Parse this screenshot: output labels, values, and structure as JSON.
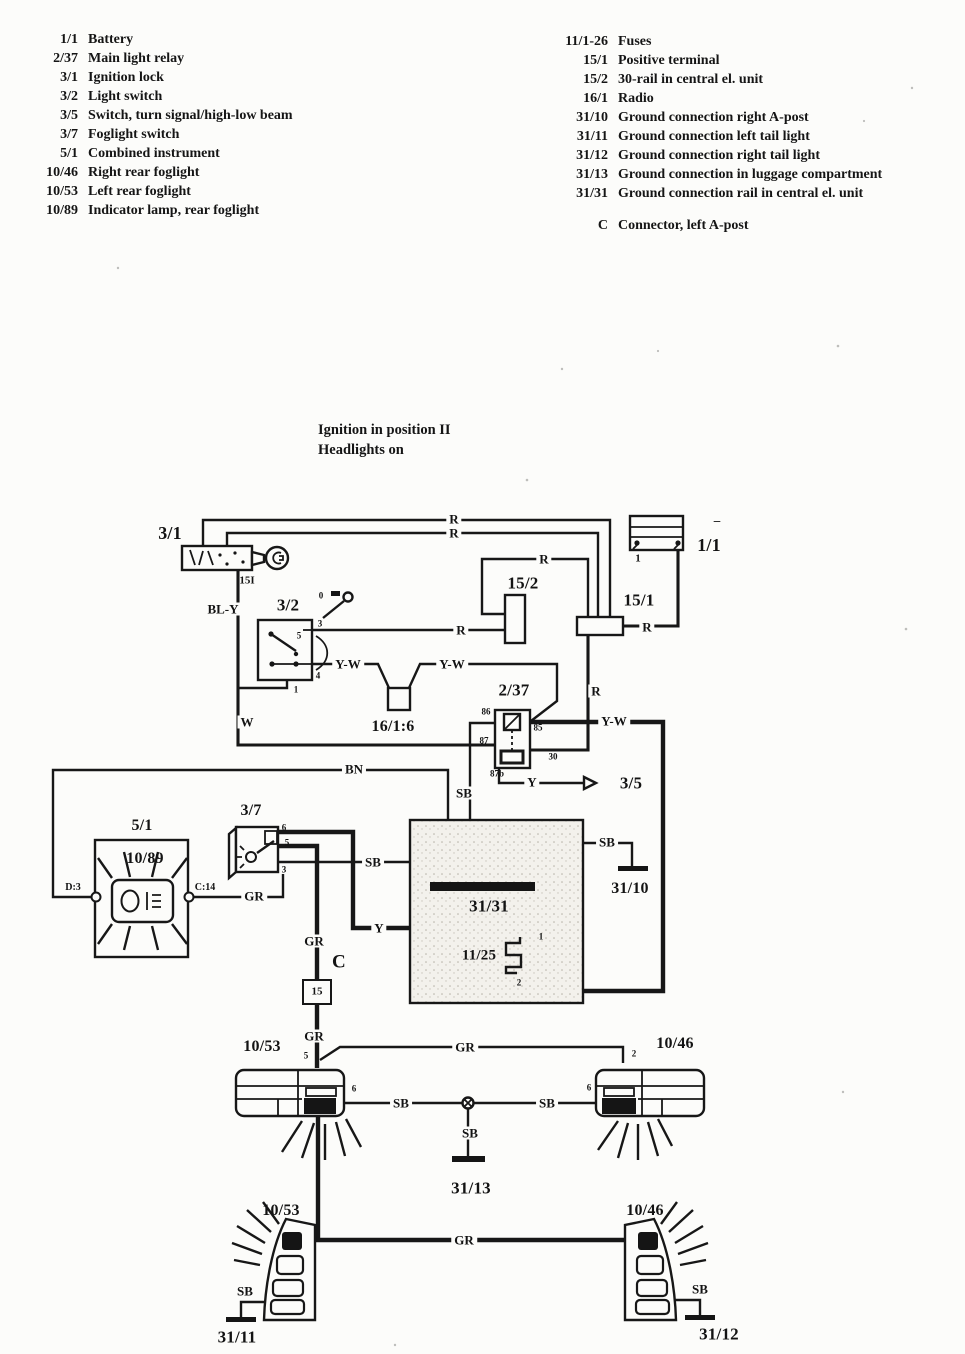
{
  "page": {
    "background": "#fcfcfa",
    "ink": "#171717"
  },
  "legend_left": {
    "items": [
      {
        "ref": "1/1",
        "label": "Battery"
      },
      {
        "ref": "2/37",
        "label": "Main light relay"
      },
      {
        "ref": "3/1",
        "label": "Ignition lock"
      },
      {
        "ref": "3/2",
        "label": "Light switch"
      },
      {
        "ref": "3/5",
        "label": "Switch, turn signal/high-low beam"
      },
      {
        "ref": "3/7",
        "label": "Foglight switch"
      },
      {
        "ref": "5/1",
        "label": "Combined instrument"
      },
      {
        "ref": "10/46",
        "label": "Right rear foglight"
      },
      {
        "ref": "10/53",
        "label": "Left rear foglight"
      },
      {
        "ref": "10/89",
        "label": "Indicator lamp, rear foglight"
      }
    ]
  },
  "legend_right": {
    "items": [
      {
        "ref": "11/1-26",
        "label": "Fuses"
      },
      {
        "ref": "15/1",
        "label": "Positive terminal"
      },
      {
        "ref": "15/2",
        "label": "30-rail in central el. unit"
      },
      {
        "ref": "16/1",
        "label": "Radio"
      },
      {
        "ref": "31/10",
        "label": "Ground connection right A-post"
      },
      {
        "ref": "31/11",
        "label": "Ground connection left tail light"
      },
      {
        "ref": "31/12",
        "label": "Ground connection right tail light"
      },
      {
        "ref": "31/13",
        "label": "Ground connection in luggage compartment"
      },
      {
        "ref": "31/31",
        "label": "Ground connection rail in central el. unit"
      }
    ],
    "connector": {
      "ref": "C",
      "label": "Connector, left A-post"
    }
  },
  "caption": {
    "line1": "Ignition in position II",
    "line2": "Headlights on"
  },
  "diagram": {
    "labels": [
      {
        "k": "comp",
        "text": "3/1",
        "x": 170,
        "y": 533,
        "s": 18,
        "name": "label-ignition-lock"
      },
      {
        "k": "comp",
        "text": "1/1",
        "x": 709,
        "y": 545,
        "s": 18,
        "name": "label-battery"
      },
      {
        "k": "comp",
        "text": "15/2",
        "x": 523,
        "y": 583,
        "s": 17,
        "name": "label-30-rail"
      },
      {
        "k": "comp",
        "text": "15/1",
        "x": 639,
        "y": 600,
        "s": 17,
        "name": "label-positive-terminal"
      },
      {
        "k": "comp",
        "text": "3/2",
        "x": 288,
        "y": 605,
        "s": 17,
        "name": "label-light-switch"
      },
      {
        "k": "comp",
        "text": "16/1:6",
        "x": 393,
        "y": 727,
        "s": 16,
        "name": "label-radio-connector"
      },
      {
        "k": "comp",
        "text": "2/37",
        "x": 514,
        "y": 690,
        "s": 17,
        "name": "label-main-light-relay"
      },
      {
        "k": "comp",
        "text": "3/5",
        "x": 631,
        "y": 783,
        "s": 17,
        "name": "label-turn-signal-switch"
      },
      {
        "k": "comp",
        "text": "5/1",
        "x": 142,
        "y": 826,
        "s": 16,
        "name": "label-combined-instrument"
      },
      {
        "k": "comp",
        "text": "10/89",
        "x": 145,
        "y": 859,
        "s": 16,
        "name": "label-indicator-lamp"
      },
      {
        "k": "comp",
        "text": "3/7",
        "x": 251,
        "y": 811,
        "s": 16,
        "name": "label-foglight-switch"
      },
      {
        "k": "comp",
        "text": "31/31",
        "x": 489,
        "y": 906,
        "s": 17,
        "name": "label-ground-rail-31-31"
      },
      {
        "k": "comp",
        "text": "31/10",
        "x": 630,
        "y": 889,
        "s": 16,
        "name": "label-ground-31-10"
      },
      {
        "k": "comp",
        "text": "11/25",
        "x": 479,
        "y": 956,
        "s": 15,
        "name": "label-fuse-11-25"
      },
      {
        "k": "comp",
        "text": "C",
        "x": 339,
        "y": 962,
        "s": 19,
        "name": "label-connector-c"
      },
      {
        "k": "comp",
        "text": "10/53",
        "x": 262,
        "y": 1047,
        "s": 16,
        "name": "label-left-foglight"
      },
      {
        "k": "comp",
        "text": "10/46",
        "x": 675,
        "y": 1044,
        "s": 16,
        "name": "label-right-foglight"
      },
      {
        "k": "comp",
        "text": "31/13",
        "x": 471,
        "y": 1188,
        "s": 17,
        "name": "label-ground-31-13"
      },
      {
        "k": "comp",
        "text": "10/53",
        "x": 281,
        "y": 1211,
        "s": 16,
        "name": "label-left-taillight"
      },
      {
        "k": "comp",
        "text": "10/46",
        "x": 645,
        "y": 1211,
        "s": 16,
        "name": "label-right-taillight"
      },
      {
        "k": "comp",
        "text": "31/11",
        "x": 237,
        "y": 1337,
        "s": 17,
        "name": "label-ground-31-11"
      },
      {
        "k": "comp",
        "text": "31/12",
        "x": 719,
        "y": 1334,
        "s": 17,
        "name": "label-ground-31-12"
      },
      {
        "k": "wire",
        "text": "R",
        "x": 454,
        "y": 519
      },
      {
        "k": "wire",
        "text": "R",
        "x": 454,
        "y": 533
      },
      {
        "k": "wire",
        "text": "R",
        "x": 544,
        "y": 559
      },
      {
        "k": "wire",
        "text": "R",
        "x": 461,
        "y": 630
      },
      {
        "k": "wire",
        "text": "R",
        "x": 647,
        "y": 627
      },
      {
        "k": "wire",
        "text": "R",
        "x": 596,
        "y": 691
      },
      {
        "k": "wire",
        "text": "BL-Y",
        "x": 223,
        "y": 609
      },
      {
        "k": "wire",
        "text": "W",
        "x": 247,
        "y": 722
      },
      {
        "k": "wire",
        "text": "Y-W",
        "x": 348,
        "y": 664
      },
      {
        "k": "wire",
        "text": "Y-W",
        "x": 452,
        "y": 664
      },
      {
        "k": "wire",
        "text": "Y-W",
        "x": 614,
        "y": 721
      },
      {
        "k": "wire",
        "text": "BN",
        "x": 354,
        "y": 769
      },
      {
        "k": "wire",
        "text": "SB",
        "x": 464,
        "y": 793
      },
      {
        "k": "wire",
        "text": "SB",
        "x": 373,
        "y": 862
      },
      {
        "k": "wire",
        "text": "SB",
        "x": 607,
        "y": 842
      },
      {
        "k": "wire",
        "text": "SB",
        "x": 401,
        "y": 1103
      },
      {
        "k": "wire",
        "text": "SB",
        "x": 547,
        "y": 1103
      },
      {
        "k": "wire",
        "text": "SB",
        "x": 470,
        "y": 1133
      },
      {
        "k": "wire",
        "text": "SB",
        "x": 245,
        "y": 1291
      },
      {
        "k": "wire",
        "text": "SB",
        "x": 700,
        "y": 1289
      },
      {
        "k": "wire",
        "text": "GR",
        "x": 254,
        "y": 896
      },
      {
        "k": "wire",
        "text": "GR",
        "x": 314,
        "y": 941
      },
      {
        "k": "wire",
        "text": "GR",
        "x": 314,
        "y": 1036
      },
      {
        "k": "wire",
        "text": "GR",
        "x": 465,
        "y": 1047
      },
      {
        "k": "wire",
        "text": "GR",
        "x": 464,
        "y": 1240
      },
      {
        "k": "wire",
        "text": "Y",
        "x": 379,
        "y": 928
      },
      {
        "k": "wire",
        "text": "Y",
        "x": 532,
        "y": 782
      },
      {
        "k": "term",
        "text": "15I",
        "x": 247,
        "y": 581,
        "s": 11
      },
      {
        "k": "term",
        "text": "1",
        "x": 638,
        "y": 559,
        "s": 11,
        "name": "term-battery-1"
      },
      {
        "k": "term",
        "text": "–",
        "x": 717,
        "y": 520,
        "s": 13,
        "name": "term-battery-minus"
      },
      {
        "k": "term",
        "text": "86",
        "x": 486,
        "y": 712
      },
      {
        "k": "term",
        "text": "85",
        "x": 538,
        "y": 728
      },
      {
        "k": "term",
        "text": "87",
        "x": 484,
        "y": 741
      },
      {
        "k": "term",
        "text": "30",
        "x": 553,
        "y": 757
      },
      {
        "k": "term",
        "text": "87b",
        "x": 497,
        "y": 774
      },
      {
        "k": "term",
        "text": "3",
        "x": 320,
        "y": 624
      },
      {
        "k": "term",
        "text": "5",
        "x": 299,
        "y": 636
      },
      {
        "k": "term",
        "text": "4",
        "x": 318,
        "y": 676
      },
      {
        "k": "term",
        "text": "1",
        "x": 296,
        "y": 690
      },
      {
        "k": "term",
        "text": "0",
        "x": 321,
        "y": 596,
        "name": "term-knob-0"
      },
      {
        "k": "term",
        "text": "6",
        "x": 284,
        "y": 828
      },
      {
        "k": "term",
        "text": "5",
        "x": 287,
        "y": 843
      },
      {
        "k": "term",
        "text": "3",
        "x": 284,
        "y": 870
      },
      {
        "k": "term",
        "text": "D:3",
        "x": 73,
        "y": 888,
        "s": 10
      },
      {
        "k": "term",
        "text": "C:14",
        "x": 205,
        "y": 888,
        "s": 10
      },
      {
        "k": "term",
        "text": "1",
        "x": 541,
        "y": 937
      },
      {
        "k": "term",
        "text": "2",
        "x": 519,
        "y": 983
      },
      {
        "k": "term",
        "text": "15",
        "x": 317,
        "y": 992,
        "s": 11,
        "name": "term-connector-15"
      },
      {
        "k": "term",
        "text": "5",
        "x": 306,
        "y": 1056
      },
      {
        "k": "term",
        "text": "6",
        "x": 354,
        "y": 1089
      },
      {
        "k": "term",
        "text": "2",
        "x": 634,
        "y": 1054
      },
      {
        "k": "term",
        "text": "6",
        "x": 589,
        "y": 1088
      }
    ]
  }
}
